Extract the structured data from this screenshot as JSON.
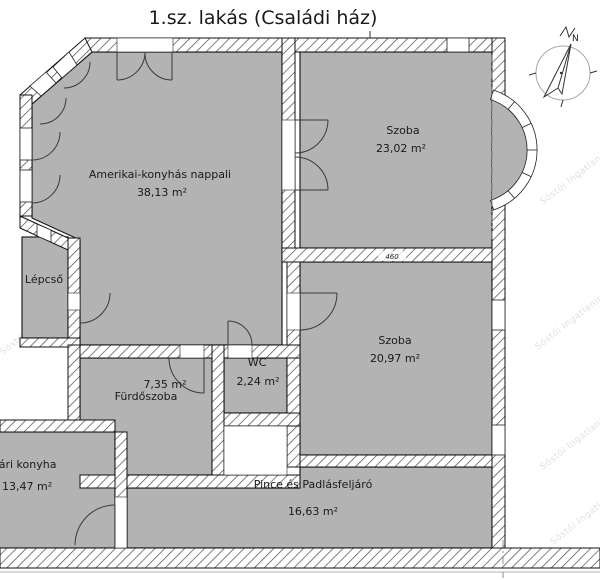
{
  "title": "1.sz. lakás (Családi ház)",
  "compass": {
    "label": "N"
  },
  "watermark": "Sóstói Ingatlaniroda",
  "dimension_label": "460",
  "rooms": [
    {
      "name": "Amerikai-konyhás nappali",
      "area": "38,13 m²"
    },
    {
      "name": "Szoba",
      "area": "23,02 m²"
    },
    {
      "name": "Szoba",
      "area": "20,97 m²"
    },
    {
      "name": "Lépcső",
      "area": ""
    },
    {
      "name": "7,35 m²",
      "area": "Fürdőszoba"
    },
    {
      "name": "WC",
      "area": "2,24 m²"
    },
    {
      "name": "Pince és Padlásfeljáró",
      "area": "16,63 m²"
    },
    {
      "name": "Nyári konyha",
      "area": "13,47 m²"
    }
  ],
  "colors": {
    "room_fill": "#b3b3b3",
    "wall_line": "#111111",
    "watermark": "#e0e0e0"
  }
}
